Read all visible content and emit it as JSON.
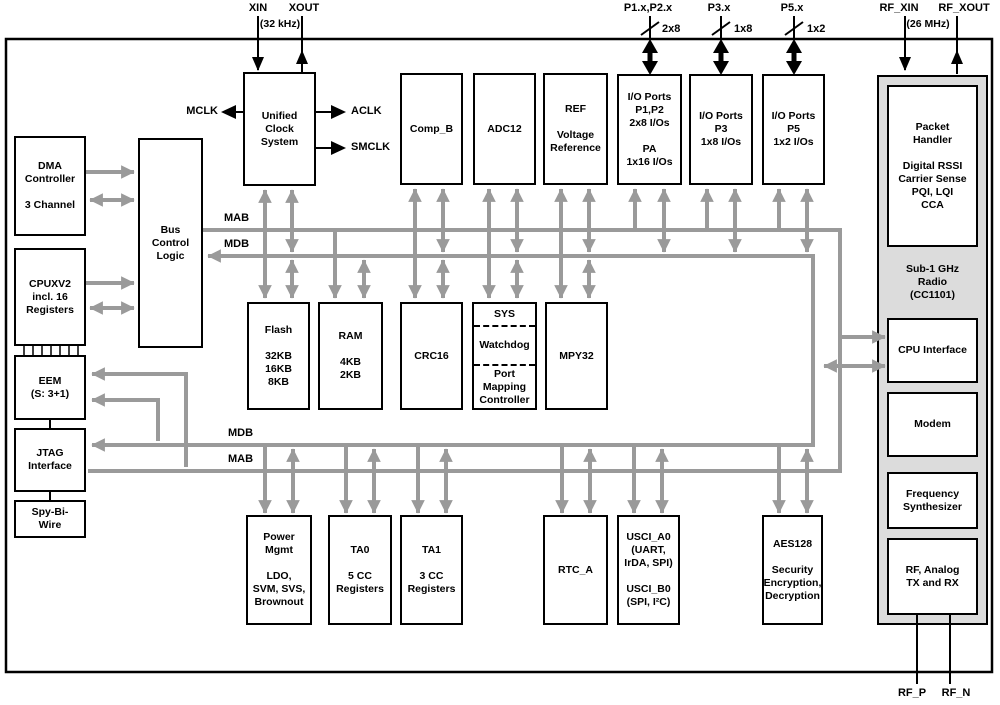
{
  "diagram_title": "MSP430 + Sub-1 GHz Radio SoC functional block diagram",
  "colors": {
    "line_gray": "#9a9a9a",
    "radio_fill": "#dcdcdc",
    "ink": "#000000",
    "block_fill": "#ffffff"
  },
  "pins": {
    "xin": "XIN",
    "xout": "XOUT",
    "xtal_freq": "(32 kHz)",
    "mclk": "MCLK",
    "aclk": "ACLK",
    "smclk": "SMCLK",
    "p12": "P1.x,P2.x",
    "p12_width": "2x8",
    "p3": "P3.x",
    "p3_width": "1x8",
    "p5": "P5.x",
    "p5_width": "1x2",
    "rf_xin": "RF_XIN",
    "rf_xout": "RF_XOUT",
    "rf_xtal_freq": "(26 MHz)",
    "rf_p": "RF_P",
    "rf_n": "RF_N"
  },
  "buses": {
    "mab_top": "MAB",
    "mdb_top": "MDB",
    "mdb_bottom": "MDB",
    "mab_bottom": "MAB"
  },
  "blocks": {
    "dma": "DMA\nController\n\n3 Channel",
    "cpu": "CPUXV2\nincl. 16\nRegisters",
    "eem": "EEM\n(S: 3+1)",
    "jtag": "JTAG\nInterface",
    "sbw": "Spy-Bi-\nWire",
    "bcl": "Bus\nControl\nLogic",
    "ucs": "Unified\nClock\nSystem",
    "comp_b": "Comp_B",
    "adc12": "ADC12",
    "ref": "REF\n\nVoltage\nReference",
    "io12": "I/O Ports\nP1,P2\n2x8 I/Os\n\nPA\n1x16 I/Os",
    "io3": "I/O Ports\nP3\n1x8 I/Os",
    "io5": "I/O Ports\nP5\n1x2 I/Os",
    "flash": "Flash\n\n32KB\n16KB\n8KB",
    "ram": "RAM\n\n4KB\n2KB",
    "crc": "CRC16",
    "sys_top": "SYS",
    "sys_mid": "Watchdog",
    "sys_bot": "Port\nMapping\nController",
    "mpy": "MPY32",
    "pmm": "Power\nMgmt\n\nLDO,\nSVM, SVS,\nBrownout",
    "ta0": "TA0\n\n5 CC\nRegisters",
    "ta1": "TA1\n\n3 CC\nRegisters",
    "rtc": "RTC_A",
    "usci": "USCI_A0\n(UART,\nIrDA, SPI)\n\nUSCI_B0\n(SPI, I²C)",
    "aes": "AES128\n\nSecurity\nEncryption,\nDecryption",
    "radio": "Sub-1 GHz\nRadio\n(CC1101)",
    "packet": "Packet\nHandler\n\nDigital RSSI\nCarrier Sense\nPQI, LQI\nCCA",
    "cpu_if": "CPU Interface",
    "modem": "Modem",
    "freq": "Frequency\nSynthesizer",
    "rf_fe": "RF, Analog\nTX and RX"
  }
}
